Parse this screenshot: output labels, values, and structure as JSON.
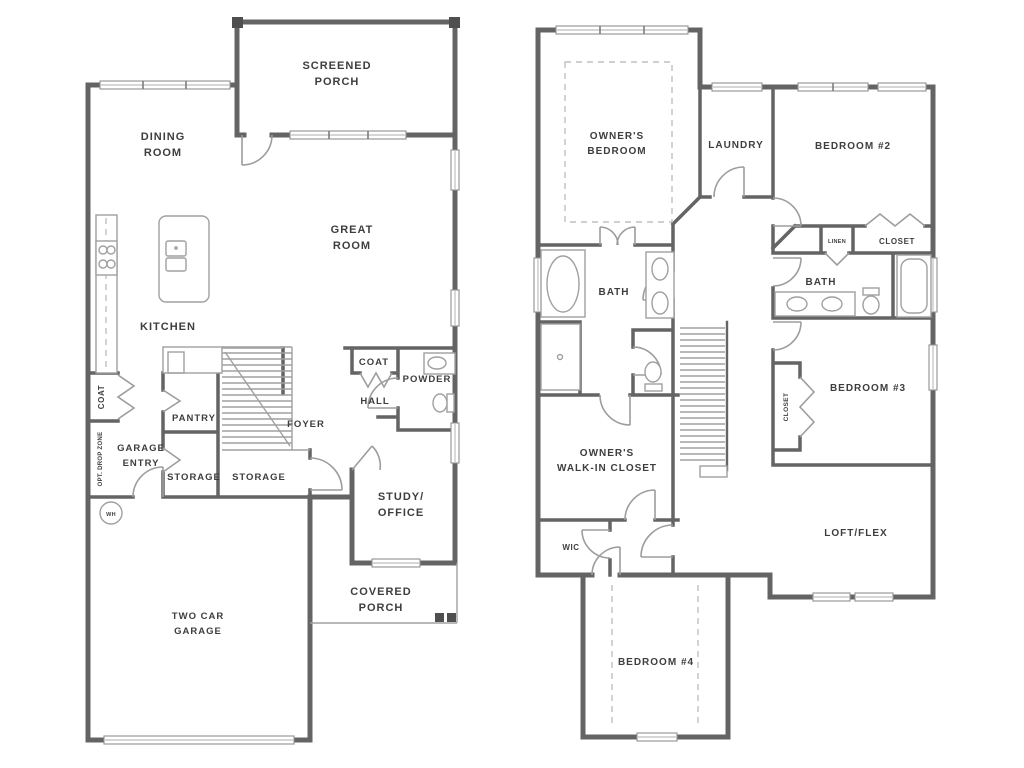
{
  "colors": {
    "wall": "#646464",
    "fixture": "#a0a0a0",
    "door": "#9d9d9d",
    "dashed": "#c0c0c0",
    "text": "#3e3e3e",
    "glass": "#c9c9c9",
    "background": "#ffffff",
    "post": "#4f4f4f"
  },
  "floor1": {
    "labels": {
      "screened_porch": [
        "SCREENED",
        "PORCH"
      ],
      "dining_room": [
        "DINING",
        "ROOM"
      ],
      "great_room": [
        "GREAT",
        "ROOM"
      ],
      "kitchen": "KITCHEN",
      "coat_closet": "COAT",
      "opt_drop_zone": "OPT. DROP ZONE",
      "garage_entry": [
        "GARAGE",
        "ENTRY"
      ],
      "pantry": "PANTRY",
      "storage_a": "STORAGE",
      "storage_b": "STORAGE",
      "foyer": "FOYER",
      "hall": "HALL",
      "hall_coat": "COAT",
      "powder": "POWDER",
      "study_office": [
        "STUDY/",
        "OFFICE"
      ],
      "covered_porch": [
        "COVERED",
        "PORCH"
      ],
      "two_car_garage": [
        "TWO CAR",
        "GARAGE"
      ],
      "water_heater": "WH"
    }
  },
  "floor2": {
    "labels": {
      "owners_bedroom": [
        "OWNER'S",
        "BEDROOM"
      ],
      "laundry": "LAUNDRY",
      "bedroom_2": "BEDROOM #2",
      "linen": "LINEN",
      "bedroom2_closet": "CLOSET",
      "bath_shared": "BATH",
      "bath_owner": "BATH",
      "bedroom_3": "BEDROOM #3",
      "bedroom3_closet": "CLOSET",
      "owners_wic": [
        "OWNER'S",
        "WALK-IN CLOSET"
      ],
      "wic": "WIC",
      "loft_flex": "LOFT/FLEX",
      "bedroom_4": "BEDROOM #4"
    }
  }
}
